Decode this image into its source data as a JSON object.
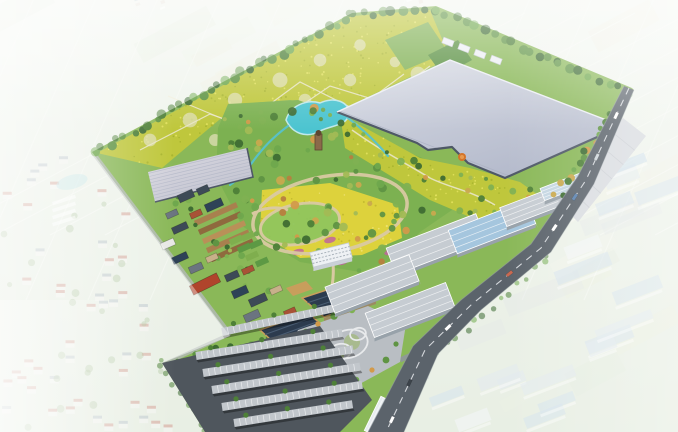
{
  "scene": {
    "viewbox": "0 0 678 432",
    "palette": {
      "bg_top": "#ebf1e7",
      "bg_bottom": "#d9e4d2",
      "field_tints": [
        "#e3ecdb",
        "#dde8d4",
        "#e9eedd",
        "#d5e2cd",
        "#e6ebd6",
        "#dfe8cb",
        "#e8e9d5"
      ],
      "grid_line": "#f4f7f0",
      "site_green": "#8ab858",
      "park_green": "#7cb151",
      "lawn": "#8cc45e",
      "crop_yellow": "#bfc73c",
      "crop_speckle": [
        "#e0e05c",
        "#a8b42e"
      ],
      "crop_circle": "#dfdfb6",
      "crop_path": "#e9e6c9",
      "green_patch1": "#7fb052",
      "green_patch2": "#578f3f",
      "flower_yellow": "#ddd23c",
      "flower_speckle": [
        "#ece270",
        "#c2b92e"
      ],
      "pink_flower": "#c0659e",
      "greenhouse_grad1": "#dadde6",
      "greenhouse_grad2": "#b2b8ca",
      "greenhouse_line": "#a9afc1",
      "greenhouse_wall": "#4e5866",
      "greenhouse_lid": "#edeff5",
      "gh2_grad1": "#dcdae2",
      "gh2_grad2": "#c0c2cf",
      "lake": "#4cc4d0",
      "lake_edge": "#bfe8ea",
      "stream": "#57c2cc",
      "island": "#7fb152",
      "path_tan": "#d9c9a2",
      "tree_greens": [
        "#3f6d33",
        "#4e8038",
        "#5f9443",
        "#6fa84d",
        "#7fb152",
        "#a2ba55"
      ],
      "tree_accents": [
        "#c9a94e",
        "#d29a4a",
        "#b7803f"
      ],
      "belt_greens": [
        "#3f6d33",
        "#4e8038",
        "#5f9443",
        "#6fa84d"
      ],
      "village_roofs": [
        "#3d4a57",
        "#6b7480",
        "#a85236",
        "#c8b08a",
        "#e8e8e6",
        "#2e4257"
      ],
      "red_building": "#b0442c",
      "white_building": "#eef1f4",
      "window_line": "#9aa4ae",
      "building_shadow": "#c9d0d6",
      "terrace_browns": [
        "#a8804e",
        "#8f6a3e",
        "#b99058"
      ],
      "veg_greens": [
        "#7fae4e",
        "#5d9944"
      ],
      "solar_roof": "#2c3b4e",
      "solar_line": "#4a5d73",
      "fascia": "#c89e5c",
      "solar_wall": "#9c8a62",
      "plaza": "#b9bec3",
      "plaza_path": "#e8eaec",
      "plaza_lawn": "#9db86a",
      "plaza_tree_mix": [
        "#5f9443",
        "#6fa84d",
        "#d29a4a",
        "#c9892f",
        "#7fb152"
      ],
      "parking_asphalt": "#4f565d",
      "carport": "#c2c7cc",
      "carport_stripe": "#eef0f2",
      "roof_gray": "#c6ccd2",
      "roof_blue": "#a5c6de",
      "roof_blue2": "#c4d6e2",
      "roof_white": "#e8edf0",
      "warehouse_wall": "#98a2aa",
      "warehouse_wall2": "#b4bec6",
      "road": "#5b636b",
      "road_line": "#e9ebee",
      "road_shoulder": "#9aa2a8",
      "slab": "#c2c7ce",
      "slab_line": "#aab0b8",
      "minor_road": "#b2b8b4",
      "entry_road": "#8f969c",
      "faded_house_body": "#f2f0ec",
      "faded_house_roofs": [
        "#b85c4a",
        "#b85c4a",
        "#8a9aa8"
      ],
      "faded_tree": "#7ba05e",
      "faded_pond": "#a8d8dc",
      "tunnel_white": "#ffffff",
      "faded_factory_roofs": [
        "#a7c6de",
        "#bcd2e2",
        "#eef2f5",
        "#cfdce6"
      ],
      "faded_yard": "#d2d8da",
      "speck_colors": [
        "#c97a6e",
        "#ffffff",
        "#98aab8",
        "#d8c8b8"
      ],
      "veil": "#ffffff",
      "sculpture1": "#d4742a",
      "sculpture2": "#e89a4e",
      "tower_brown": "#8a6a4a",
      "tower_dark": "#5e4630",
      "vehicle_colors": [
        "#ffffff",
        "#cdd5da",
        "#5a82b0",
        "#ffffff",
        "#c86850",
        "#ffffff",
        "#3c434a",
        "#ffffff"
      ]
    },
    "geometry": {
      "site_outline": [
        [
          92,
          152
        ],
        [
          352,
          13
        ],
        [
          436,
          6
        ],
        [
          632,
          88
        ],
        [
          634,
          90
        ],
        [
          594,
          184
        ],
        [
          551,
          252
        ],
        [
          481,
          310
        ],
        [
          438,
          354
        ],
        [
          404,
          432
        ],
        [
          205,
          432
        ],
        [
          162,
          363
        ],
        [
          230,
          336
        ]
      ],
      "crop_field": [
        [
          97,
          153
        ],
        [
          352,
          16
        ],
        [
          430,
          10
        ],
        [
          450,
          58
        ],
        [
          340,
          110
        ],
        [
          290,
          100
        ],
        [
          238,
          104
        ],
        [
          162,
          168
        ]
      ],
      "crop_circles": [
        [
          150,
          140
        ],
        [
          190,
          120
        ],
        [
          235,
          100
        ],
        [
          280,
          80
        ],
        [
          320,
          60
        ],
        [
          360,
          45
        ],
        [
          215,
          140
        ],
        [
          260,
          120
        ],
        [
          305,
          100
        ],
        [
          350,
          80
        ],
        [
          395,
          62
        ],
        [
          300,
          135
        ],
        [
          345,
          115
        ],
        [
          390,
          95
        ],
        [
          418,
          74
        ]
      ],
      "crop_zigzags": [
        [
          [
            140,
            150
          ],
          [
            210,
            114
          ],
          [
            262,
            132
          ],
          [
            330,
            86
          ],
          [
            382,
            102
          ],
          [
            430,
            66
          ]
        ],
        [
          [
            168,
            96
          ],
          [
            240,
            126
          ],
          [
            300,
            82
          ],
          [
            356,
            110
          ],
          [
            404,
            74
          ]
        ]
      ],
      "green_patches": [
        [
          [
            385,
            40
          ],
          [
            428,
            22
          ],
          [
            448,
            52
          ],
          [
            405,
            70
          ]
        ],
        [
          [
            428,
            55
          ],
          [
            458,
            40
          ],
          [
            472,
            60
          ],
          [
            443,
            76
          ]
        ]
      ],
      "greenhouse": [
        [
          450,
          60
        ],
        [
          622,
          126
        ],
        [
          505,
          178
        ],
        [
          468,
          163
        ],
        [
          452,
          147
        ],
        [
          428,
          150
        ],
        [
          417,
          143
        ],
        [
          337,
          112
        ]
      ],
      "greenhouse2": [
        [
          148,
          172
        ],
        [
          247,
          148
        ],
        [
          253,
          177
        ],
        [
          155,
          202
        ]
      ],
      "support_boxes": [
        [
          448,
          42
        ],
        [
          464,
          48
        ],
        [
          480,
          54
        ],
        [
          496,
          60
        ]
      ],
      "park": [
        [
          228,
          104
        ],
        [
          298,
          100
        ],
        [
          338,
          114
        ],
        [
          392,
          146
        ],
        [
          448,
          168
        ],
        [
          470,
          178
        ],
        [
          452,
          210
        ],
        [
          420,
          232
        ],
        [
          398,
          258
        ],
        [
          360,
          272
        ],
        [
          300,
          262
        ],
        [
          242,
          226
        ],
        [
          216,
          176
        ],
        [
          218,
          128
        ]
      ],
      "yellow_band": [
        [
          340,
          114
        ],
        [
          420,
          158
        ],
        [
          470,
          168
        ],
        [
          520,
          182
        ],
        [
          545,
          200
        ],
        [
          505,
          232
        ],
        [
          430,
          200
        ],
        [
          345,
          148
        ]
      ],
      "band_path": "M352,130 C380,150 400,160 430,178 C450,188 470,190 495,205",
      "lake_path": "M286,120 C290,106 306,99 320,103 C334,96 350,102 349,114 C347,126 332,125 320,131 C306,139 292,133 286,120 Z",
      "islands": [
        [
          312,
          113,
          3
        ],
        [
          330,
          115,
          2
        ]
      ],
      "streams": [
        "M288,126 C272,138 263,148 254,160 C247,170 240,178 230,185",
        "M348,118 C366,132 378,144 388,156"
      ],
      "ring1": {
        "cx": 330,
        "cy": 214,
        "rx": 78,
        "ry": 38,
        "rot": -10
      },
      "ring2": {
        "cx": 300,
        "cy": 224,
        "rx": 40,
        "ry": 20,
        "rot": -10
      },
      "park_connectors": [
        "M252,214 C262,208 276,206 288,210",
        "M332,252 C334,268 334,280 330,296"
      ],
      "tower": [
        315,
        134,
        7,
        16
      ],
      "sculpture": [
        462,
        157
      ],
      "flower_field": [
        [
          262,
          190
        ],
        [
          330,
          183
        ],
        [
          398,
          205
        ],
        [
          402,
          238
        ],
        [
          362,
          255
        ],
        [
          300,
          258
        ],
        [
          260,
          233
        ]
      ],
      "pink_blobs": [
        [
          298,
          252
        ],
        [
          342,
          262
        ],
        [
          390,
          252
        ],
        [
          436,
          258
        ],
        [
          330,
          240
        ]
      ],
      "terrace_origin": [
        216,
        214
      ],
      "terrace_step": [
        4,
        9.1
      ],
      "veg_plots": [
        [
          236,
          240
        ],
        [
          244,
          248
        ],
        [
          252,
          256
        ],
        [
          262,
          262
        ],
        [
          248,
          236
        ],
        [
          256,
          244
        ]
      ],
      "village_buildings": [
        [
          186,
          196,
          16,
          8,
          -24,
          0
        ],
        [
          203,
          190,
          12,
          7,
          -24,
          0
        ],
        [
          214,
          205,
          18,
          8,
          -24,
          5
        ],
        [
          196,
          214,
          12,
          6,
          -24,
          2
        ],
        [
          172,
          214,
          12,
          6,
          -24,
          1
        ],
        [
          180,
          228,
          16,
          7,
          -24,
          0
        ],
        [
          168,
          244,
          14,
          7,
          -24,
          4
        ],
        [
          180,
          258,
          16,
          7,
          -24,
          5
        ],
        [
          196,
          268,
          14,
          7,
          -24,
          1
        ],
        [
          212,
          258,
          12,
          6,
          -24,
          3
        ],
        [
          232,
          276,
          14,
          7,
          -24,
          0
        ],
        [
          248,
          270,
          12,
          6,
          -24,
          2
        ],
        [
          240,
          292,
          16,
          8,
          -24,
          5
        ],
        [
          258,
          300,
          18,
          8,
          -24,
          0
        ],
        [
          276,
          290,
          12,
          6,
          -24,
          3
        ],
        [
          252,
          316,
          16,
          8,
          -24,
          1
        ],
        [
          270,
          322,
          14,
          7,
          -24,
          5
        ],
        [
          290,
          312,
          12,
          6,
          -24,
          2
        ]
      ],
      "red_long_building": [
        205,
        284,
        30,
        10,
        -26
      ],
      "midrise": [
        331,
        255,
        40,
        15,
        -14
      ],
      "entrance_b1": [
        [
          302,
          298
        ],
        [
          354,
          281
        ],
        [
          376,
          299
        ],
        [
          324,
          317
        ]
      ],
      "entrance_b2": [
        [
          260,
          330
        ],
        [
          308,
          313
        ],
        [
          328,
          330
        ],
        [
          280,
          348
        ]
      ],
      "entrance_small": [
        [
          286,
          288
        ],
        [
          306,
          281
        ],
        [
          313,
          289
        ],
        [
          293,
          296
        ]
      ],
      "plaza": [
        [
          298,
          330
        ],
        [
          368,
          306
        ],
        [
          406,
          324
        ],
        [
          400,
          362
        ],
        [
          356,
          386
        ],
        [
          308,
          374
        ],
        [
          288,
          350
        ]
      ],
      "plaza_rings": [
        [
          348,
          344,
          20,
          14
        ],
        [
          340,
          352,
          11,
          8
        ],
        [
          358,
          334,
          8,
          6
        ]
      ],
      "plaza_trees": [
        [
          306,
          332
        ],
        [
          316,
          344
        ],
        [
          310,
          360
        ],
        [
          322,
          372
        ],
        [
          338,
          380
        ],
        [
          356,
          380
        ],
        [
          372,
          370
        ],
        [
          386,
          360
        ],
        [
          396,
          344
        ],
        [
          386,
          326
        ],
        [
          370,
          316
        ],
        [
          352,
          310
        ],
        [
          334,
          316
        ],
        [
          318,
          324
        ]
      ],
      "parking": [
        [
          162,
          363
        ],
        [
          320,
          326
        ],
        [
          372,
          400
        ],
        [
          340,
          432
        ],
        [
          205,
          432
        ]
      ],
      "parking_rows": [
        [
          222,
          332,
          118,
          -12
        ],
        [
          196,
          356,
          148,
          -9
        ],
        [
          203,
          373,
          152,
          -9
        ],
        [
          212,
          390,
          150,
          -9
        ],
        [
          222,
          407,
          142,
          -9
        ],
        [
          234,
          423,
          120,
          -9
        ]
      ],
      "warehouses": [
        [
          436,
          244,
          96,
          28,
          -21,
          "roof_gray"
        ],
        [
          492,
          227,
          84,
          25,
          -21,
          "roof_blue"
        ],
        [
          535,
          205,
          68,
          20,
          -21,
          "roof_gray"
        ],
        [
          562,
          187,
          42,
          13,
          -21,
          "roof_blue2"
        ],
        [
          372,
          284,
          90,
          28,
          -21,
          "roof_gray"
        ],
        [
          410,
          310,
          86,
          26,
          -21,
          "roof_gray"
        ],
        [
          378,
          416,
          38,
          12,
          -64,
          "roof_white"
        ],
        [
          416,
          386,
          30,
          10,
          -64,
          "roof_white"
        ]
      ],
      "slab": [
        [
          623,
          118
        ],
        [
          646,
          136
        ],
        [
          578,
          222
        ],
        [
          558,
          202
        ]
      ],
      "hedge_line": [
        [
          612,
          112
        ],
        [
          556,
          198
        ]
      ],
      "belt_segments": [
        [
          [
            94,
            153
          ],
          [
            352,
            15
          ],
          34
        ],
        [
          [
            352,
            15
          ],
          [
            434,
            9
          ],
          9
        ],
        [
          [
            436,
            10
          ],
          [
            560,
            64
          ],
          14
        ],
        [
          [
            560,
            64
          ],
          [
            630,
            92
          ],
          8
        ]
      ],
      "minor_roads": [
        "M94,154 L230,334",
        "M230,334 L164,364",
        "M552,206 C500,230 448,254 398,274 C380,281 370,290 364,300"
      ],
      "entry_road": "M400,360 C418,352 432,346 448,340",
      "road_left": [
        [
          624,
          86
        ],
        [
          578,
          176
        ],
        [
          531,
          244
        ],
        [
          461,
          300
        ],
        [
          413,
          346
        ],
        [
          368,
          432
        ]
      ],
      "road_right": [
        [
          634,
          90
        ],
        [
          594,
          184
        ],
        [
          551,
          252
        ],
        [
          481,
          310
        ],
        [
          438,
          354
        ],
        [
          404,
          432
        ]
      ],
      "road_centers": [
        [
          629,
          88
        ],
        [
          586,
          180
        ],
        [
          541,
          248
        ],
        [
          471,
          305
        ],
        [
          425,
          350
        ],
        [
          386,
          432
        ]
      ],
      "vehicles": [
        [
          0,
          0.3,
          0
        ],
        [
          0,
          0.75,
          1
        ],
        [
          1,
          0.25,
          2
        ],
        [
          1,
          0.7,
          3
        ],
        [
          2,
          0.45,
          4
        ],
        [
          3,
          0.5,
          5
        ],
        [
          4,
          0.4,
          6
        ],
        [
          4,
          0.85,
          7
        ]
      ],
      "pond": [
        72,
        182,
        16,
        7,
        -15
      ],
      "tunnels_origin": [
        52,
        200
      ],
      "west_boundary": {
        "p0": [
          93,
          153
        ],
        "slope": 0.733
      },
      "speck_bands": [
        [
          120,
          255,
          2,
          26,
          16
        ],
        [
          388,
          575,
          2,
          34,
          18
        ]
      ]
    }
  }
}
